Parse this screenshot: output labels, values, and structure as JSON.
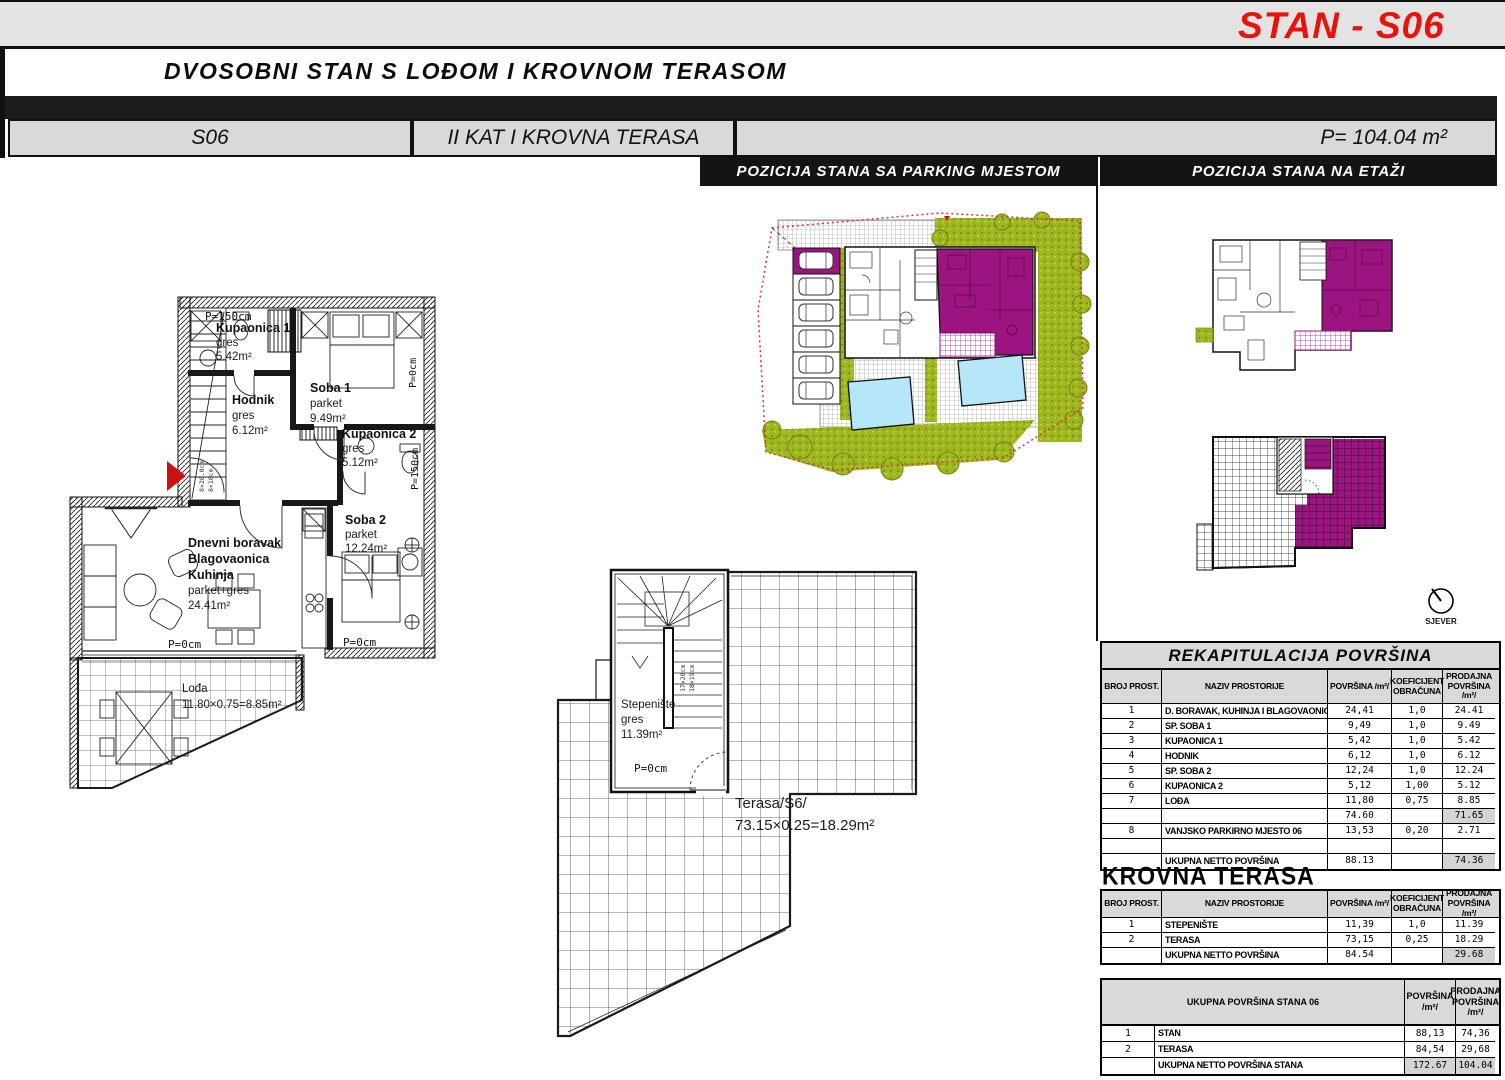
{
  "page": {
    "stan_title": "STAN - S06",
    "subtitle": "DVOSOBNI STAN S LOĐOM I KROVNOM TERASOM",
    "unit_cell": "S06",
    "floor_cell": "II KAT I KROVNA TERASA",
    "area_cell": "P= 104.04 m²",
    "section_parking": "POZICIJA STANA SA PARKING MJESTOM",
    "section_etaza": "POZICIJA STANA NA ETAŽI"
  },
  "colors": {
    "accent_red": "#e8140c",
    "highlight_magenta": "#9c1480",
    "landscape_green": "#9fb71f",
    "pool_blue": "#b5e7f8"
  },
  "floor_plan": {
    "p150_top": "P=150cm",
    "kupaonica1": {
      "name": "Kupaonica 1",
      "l1": "gres",
      "l2": "5.42m²"
    },
    "hodnik": {
      "name": "Hodnik",
      "l1": "gres",
      "l2": "6.12m²"
    },
    "soba1": {
      "name": "Soba 1",
      "l1": "parket",
      "l2": "9.49m²"
    },
    "p0_right": "P=0cm",
    "kupaonica2": {
      "name": "Kupaonica 2",
      "l1": "gres",
      "l2": "5.12m²"
    },
    "p150_right": "P=150cm",
    "soba2": {
      "name": "Soba 2",
      "l1": "parket",
      "l2": "12.24m²"
    },
    "dnevni": {
      "n1": "Dnevni boravak",
      "n2": "Blagovaonica",
      "n3": "Kuhinja",
      "l1": "parket+gres",
      "l2": "24.41m²"
    },
    "p0_living": "P=0cm",
    "p0_soba2": "P=0cm",
    "lodja": {
      "name": "Lođa",
      "l1": "11.80×0.75=8.85m²"
    },
    "stair_dim1": "8×28.0cm",
    "stair_dim2": "8×18cm"
  },
  "terrace_plan": {
    "stepeniste": {
      "name": "Stepenište",
      "l1": "gres",
      "l2": "11.39m²"
    },
    "p0": "P=0cm",
    "stair_dim1": "17×28cm",
    "stair_dim2": "18×19cm",
    "terasa": {
      "name": "Terasa/S6/",
      "l1": "73.15×0.25=18.29m²"
    }
  },
  "compass": {
    "label": "SJEVER"
  },
  "tables": {
    "col_headers": {
      "broj": "BROJ PROST.",
      "naziv": "NAZIV PROSTORIJE",
      "povrsina": "POVRŠINA /m²/",
      "koef": "KOEFICIJENT OBRAČUNA",
      "prodajna": "PRODAJNA POVRŠINA /m²/"
    },
    "rekap": {
      "title": "REKAPITULACIJA POVRŠINA",
      "rows": [
        {
          "num": "1",
          "name": "D. BORAVAK, KUHINJA I BLAGOVAONICA",
          "area": "24,41",
          "koef": "1,0",
          "prod": "24.41"
        },
        {
          "num": "2",
          "name": "SP. SOBA 1",
          "area": "9,49",
          "koef": "1,0",
          "prod": "9.49"
        },
        {
          "num": "3",
          "name": "KUPAONICA 1",
          "area": "5,42",
          "koef": "1,0",
          "prod": "5.42"
        },
        {
          "num": "4",
          "name": "HODNIK",
          "area": "6,12",
          "koef": "1,0",
          "prod": "6.12"
        },
        {
          "num": "5",
          "name": "SP. SOBA 2",
          "area": "12,24",
          "koef": "1,0",
          "prod": "12.24"
        },
        {
          "num": "6",
          "name": "KUPAONICA 2",
          "area": "5,12",
          "koef": "1,00",
          "prod": "5.12"
        },
        {
          "num": "7",
          "name": "LOĐA",
          "area": "11,80",
          "koef": "0,75",
          "prod": "8.85"
        },
        {
          "num": "",
          "name": "",
          "area": "74.60",
          "koef": "",
          "prod": "71.65"
        },
        {
          "num": "8",
          "name": "VANJSKO PARKIRNO MJESTO 06",
          "area": "13,53",
          "koef": "0,20",
          "prod": "2.71"
        },
        {
          "num": "",
          "name": "",
          "area": "",
          "koef": "",
          "prod": ""
        },
        {
          "num": "",
          "name": "UKUPNA NETTO POVRŠINA",
          "area": "88.13",
          "koef": "",
          "prod": "74.36"
        }
      ]
    },
    "krovna": {
      "title": "KROVNA TERASA",
      "rows": [
        {
          "num": "1",
          "name": "STEPENIŠTE",
          "area": "11,39",
          "koef": "1,0",
          "prod": "11.39"
        },
        {
          "num": "2",
          "name": "TERASA",
          "area": "73,15",
          "koef": "0,25",
          "prod": "18.29"
        },
        {
          "num": "",
          "name": "UKUPNA NETTO POVRŠINA",
          "area": "84.54",
          "koef": "",
          "prod": "29.68"
        }
      ]
    },
    "ukupna": {
      "title": "UKUPNA POVRŠINA STANA 06",
      "col_povrsina": "POVRŠINA /m²/",
      "col_prodajna": "PRODAJNA POVRŠINA /m²/",
      "rows": [
        {
          "num": "1",
          "name": "STAN",
          "area": "88,13",
          "prod": "74,36"
        },
        {
          "num": "2",
          "name": "TERASA",
          "area": "84,54",
          "prod": "29,68"
        },
        {
          "num": "",
          "name": "UKUPNA NETTO POVRŠINA STANA",
          "area": "172.67",
          "prod": "104.04"
        }
      ]
    }
  }
}
